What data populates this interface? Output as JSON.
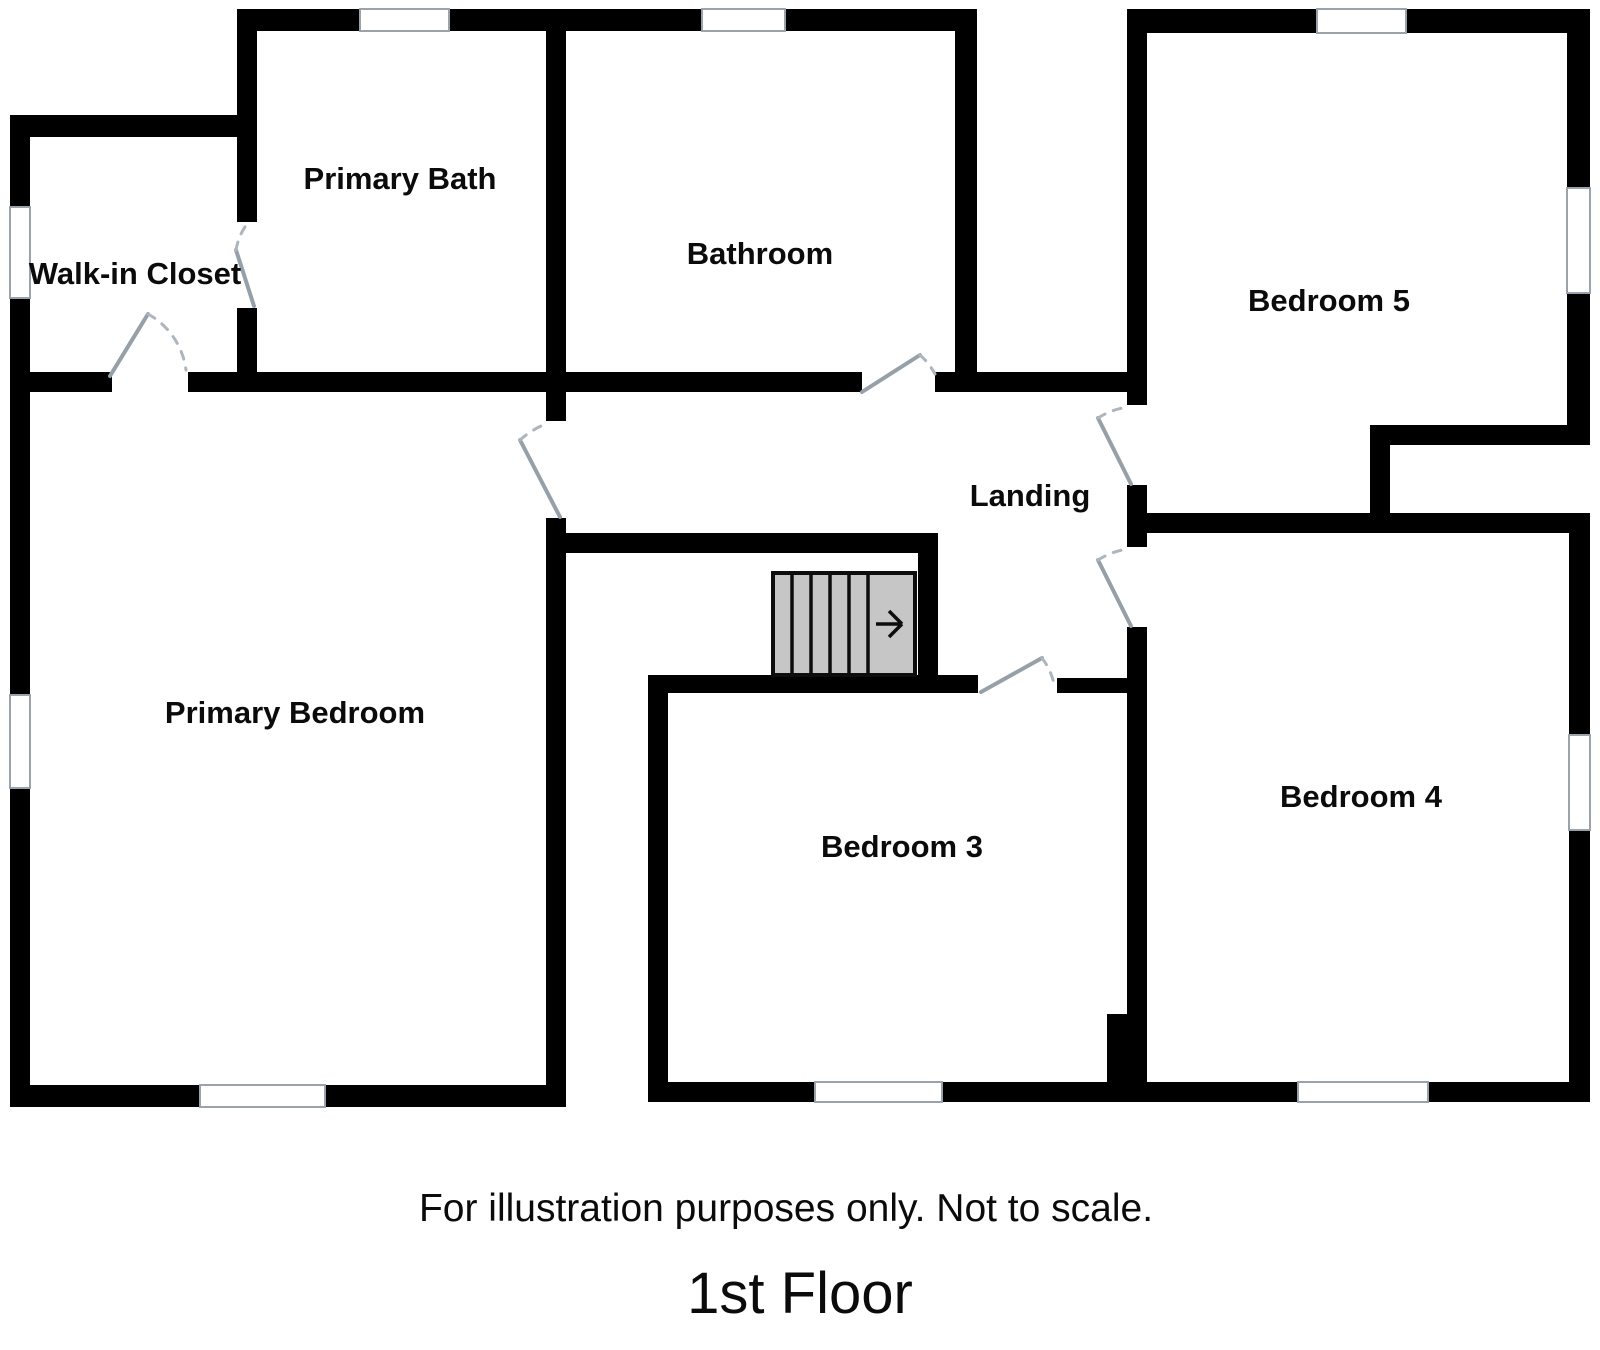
{
  "plan": {
    "rooms": [
      {
        "id": "walk-in-closet",
        "label": "Walk-in Closet"
      },
      {
        "id": "primary-bath",
        "label": "Primary Bath"
      },
      {
        "id": "bathroom",
        "label": "Bathroom"
      },
      {
        "id": "bedroom-5",
        "label": "Bedroom 5"
      },
      {
        "id": "landing",
        "label": "Landing"
      },
      {
        "id": "primary-bedroom",
        "label": "Primary Bedroom"
      },
      {
        "id": "bedroom-3",
        "label": "Bedroom 3"
      },
      {
        "id": "bedroom-4",
        "label": "Bedroom 4"
      }
    ],
    "stairs": {
      "icon": "stairs-direction-right-arrow-icon"
    },
    "colors": {
      "wall": "#000000",
      "stair_fill": "#c6c6c6",
      "door_leaf": "#96a0a9",
      "door_arc": "#aeb6bd",
      "window_line": "#9aa3ab",
      "text": "#0b0b0b"
    }
  },
  "footer": {
    "disclaimer": "For illustration purposes only. Not to scale.",
    "floor_title": "1st Floor"
  }
}
